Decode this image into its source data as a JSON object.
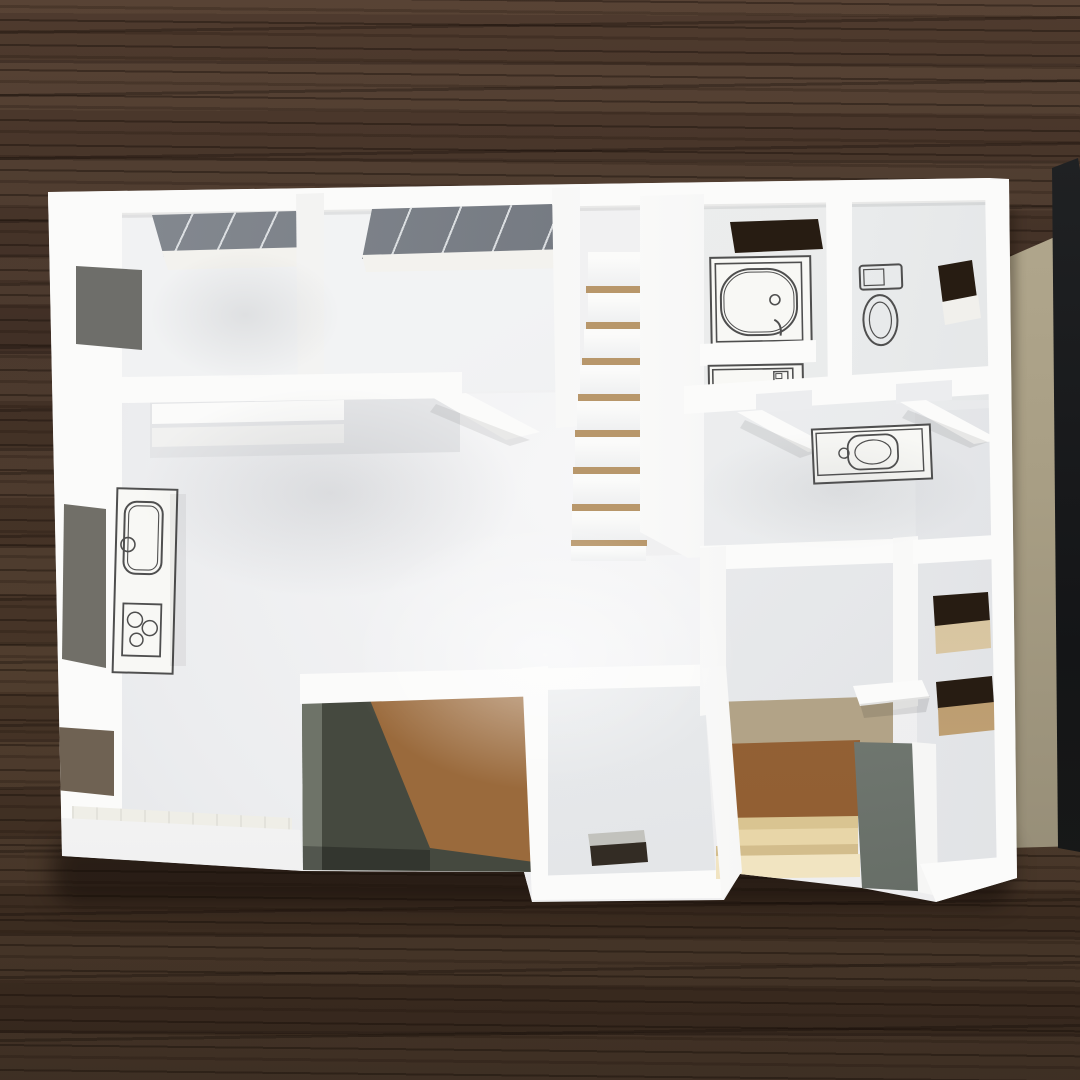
{
  "image": {
    "width": 1080,
    "height": 1080,
    "kind": "photograph",
    "subject": "white architectural scale model of a single-floor house plan, viewed from above, standing on a dark wood-grain table"
  },
  "palette": {
    "wood-top": "#4f3b2e",
    "wood-mid": "#413026",
    "wood-low": "#473527",
    "wood-bottom": "#34261c",
    "model-base": "#ededee",
    "wall-bright": "#fbfbfa",
    "wall-white": "#f6f6f5",
    "wall-shade": "#e9eaec",
    "floor-light": "#f7f7f8",
    "floor-mid": "#ecedef",
    "floor-dark": "#dfe1e4",
    "glass-dark": "#6d727a",
    "glass-mid": "#888d94",
    "slot-dark": "#271c12",
    "sill-tan": "#c8ae83",
    "stair-gap": "#b8976b",
    "notch-dark": "#45493f",
    "notch-mid": "#6e7368",
    "notch-brown": "#9a6a3c",
    "genkan-brown": "#925f33",
    "genkan-tan": "#b2a387",
    "step-cream": "#e8d6a8",
    "step-cream-light": "#f1e4c1",
    "gray-wall-light": "#99a099",
    "gray-wall-dark": "#5c635c",
    "beige-light": "#b7ad93",
    "beige-dark": "#8d8571",
    "edge-black": "#141517",
    "ink": "#4f4f4f",
    "paper": "#f8f8f5"
  },
  "scene": {
    "background": "dark espresso wood table with horizontal grain streaks",
    "side_objects": [
      "beige mat board standing at right",
      "black board edge strip at far right"
    ],
    "model_regions": [
      "bedroom-1 with printed glazing in top wall and window slot in left wall",
      "bedroom-2 with printed glazing in top wall",
      "closet strips below bedrooms",
      "staircase with tan gaps between treads",
      "bathroom with printed bathtub and washing machine",
      "toilet room with printed toilet and window slot",
      "washbasin print in corridor",
      "kitchen counter print with sink and three-burner stove",
      "living-dining floor with window slots in left wall",
      "tatami mat strip at bottom-left",
      "dark recessed porch with cardboard floor",
      "center-right room",
      "genkan entrance with cream steps and brown floor",
      "gray side wall at entrance",
      "right room with two window slots"
    ]
  }
}
